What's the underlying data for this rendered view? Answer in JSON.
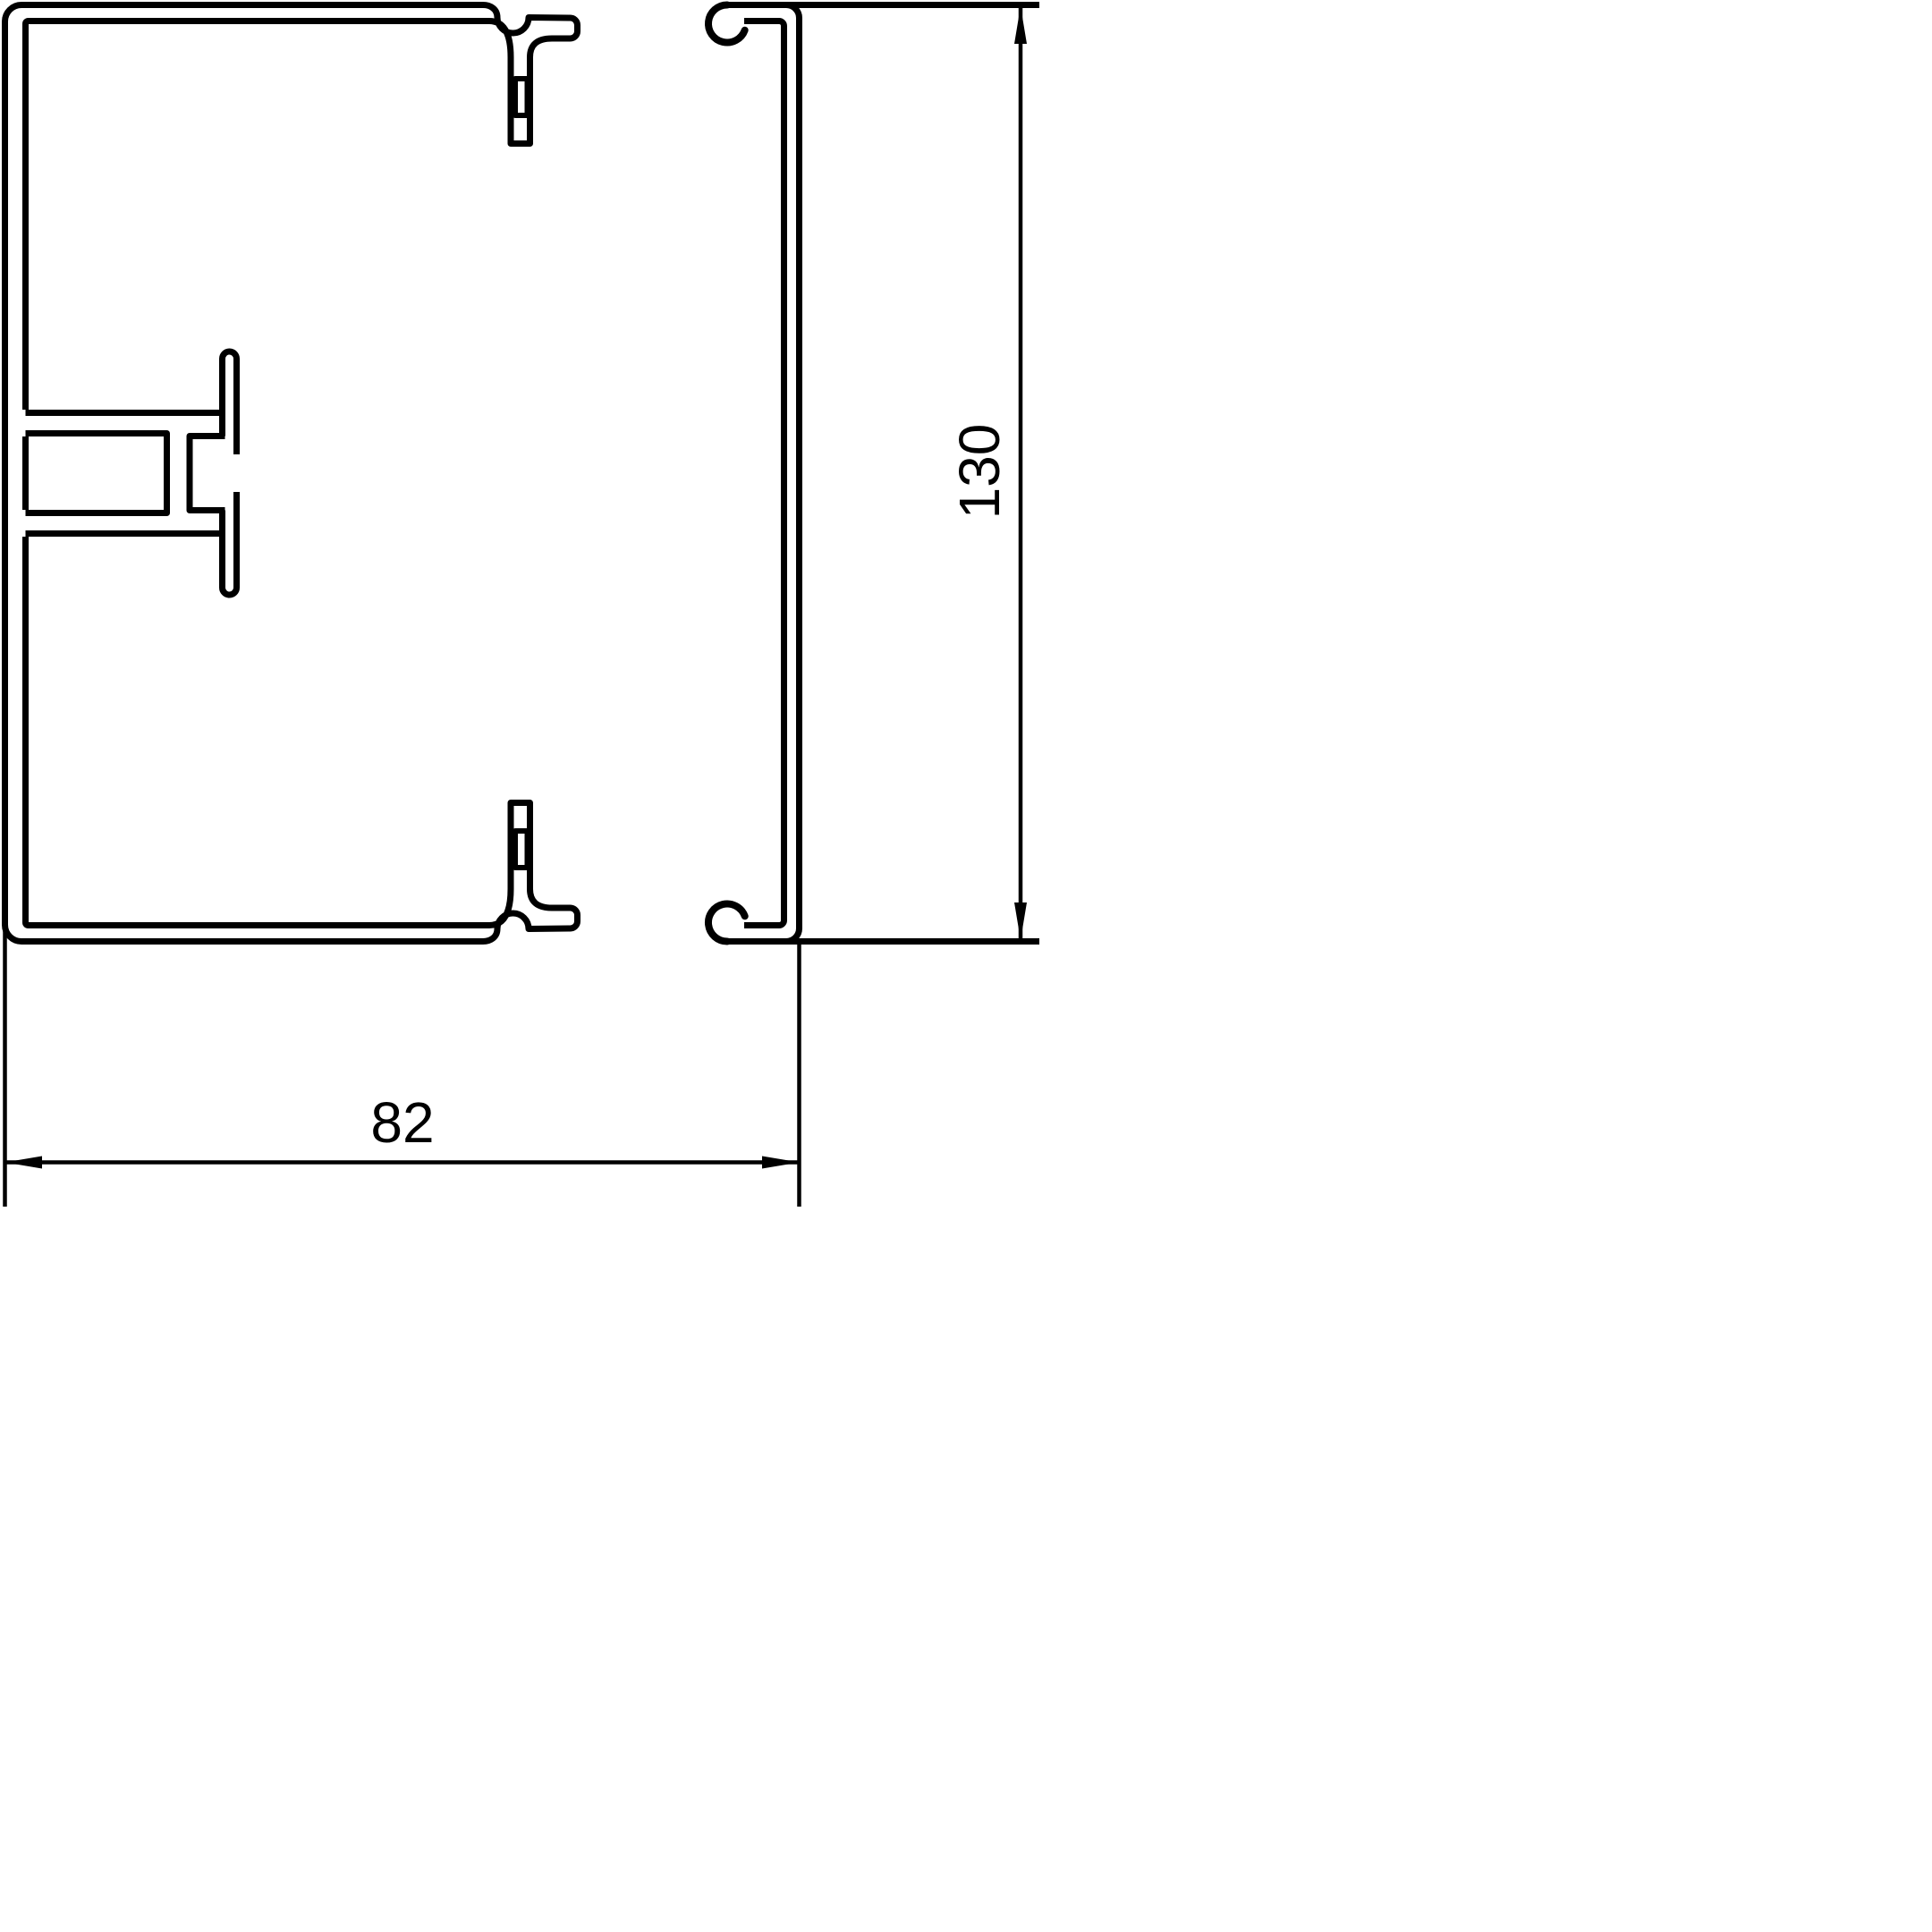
{
  "drawing": {
    "background_color": "#ffffff",
    "line_color": "#000000",
    "dimensions": {
      "width": {
        "label": "82"
      },
      "height": {
        "label": "130"
      }
    }
  }
}
